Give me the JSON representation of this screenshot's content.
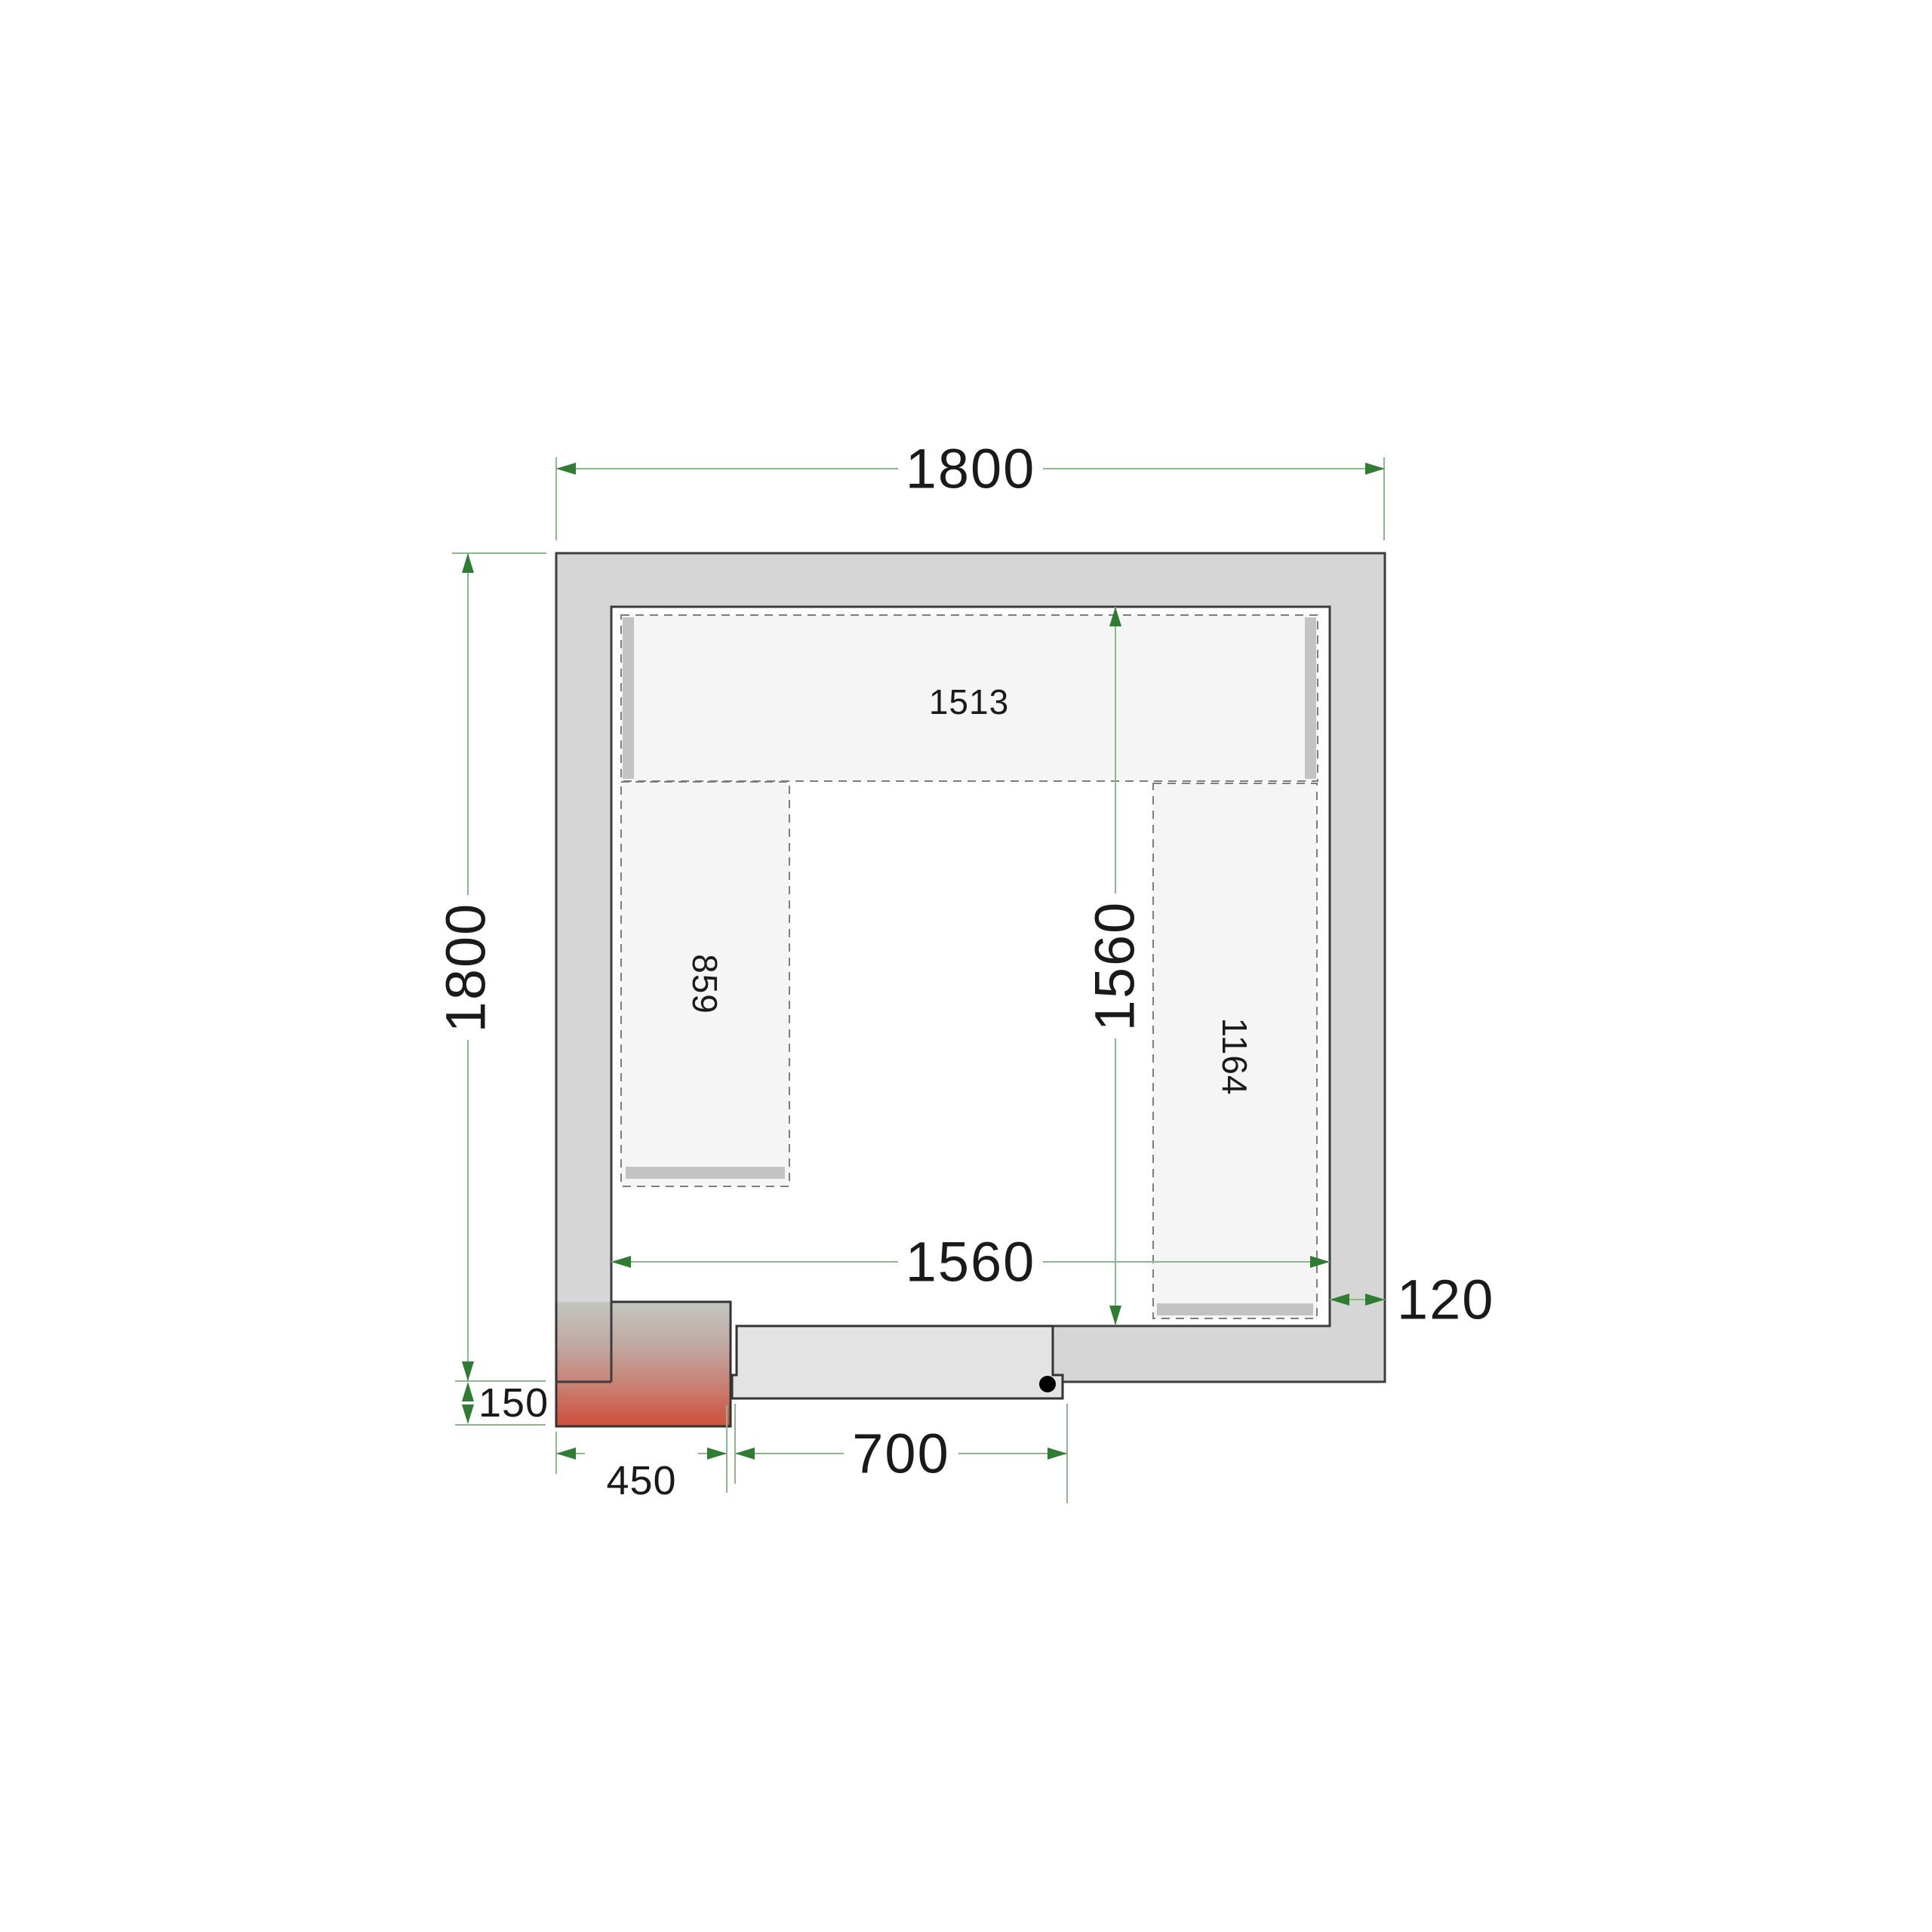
{
  "drawing": {
    "type": "cold-room floor plan, top view",
    "dims": {
      "outer_width": "1800",
      "outer_height": "1800",
      "inner_width": "1560",
      "inner_height": "1560",
      "wall_thickness": "120",
      "unit_width": "450",
      "unit_protrusion": "150",
      "door_width": "700"
    },
    "shelves": {
      "top_length": "1513",
      "left_length": "859",
      "right_length": "1164"
    }
  },
  "colors": {
    "background": "#ffffff",
    "wall_fill": "#d6d6d6",
    "wall_stroke": "#3d3d3d",
    "shelf_fill": "#f5f5f5",
    "shelf_stroke": "#7d7d7d",
    "shelf_bar": "#c3c3c3",
    "door_fill": "#e3e3e3",
    "door_stroke": "#333333",
    "hinge": "#000000",
    "dim_line": "#8cb98c",
    "dim_arrow": "#2e7d33",
    "dim_text": "#1a1a1a",
    "unit_top": "#c2c7bf",
    "unit_mid1": "#c0a8a2",
    "unit_mid2": "#c97f72",
    "unit_bottom": "#cf4e3b"
  }
}
